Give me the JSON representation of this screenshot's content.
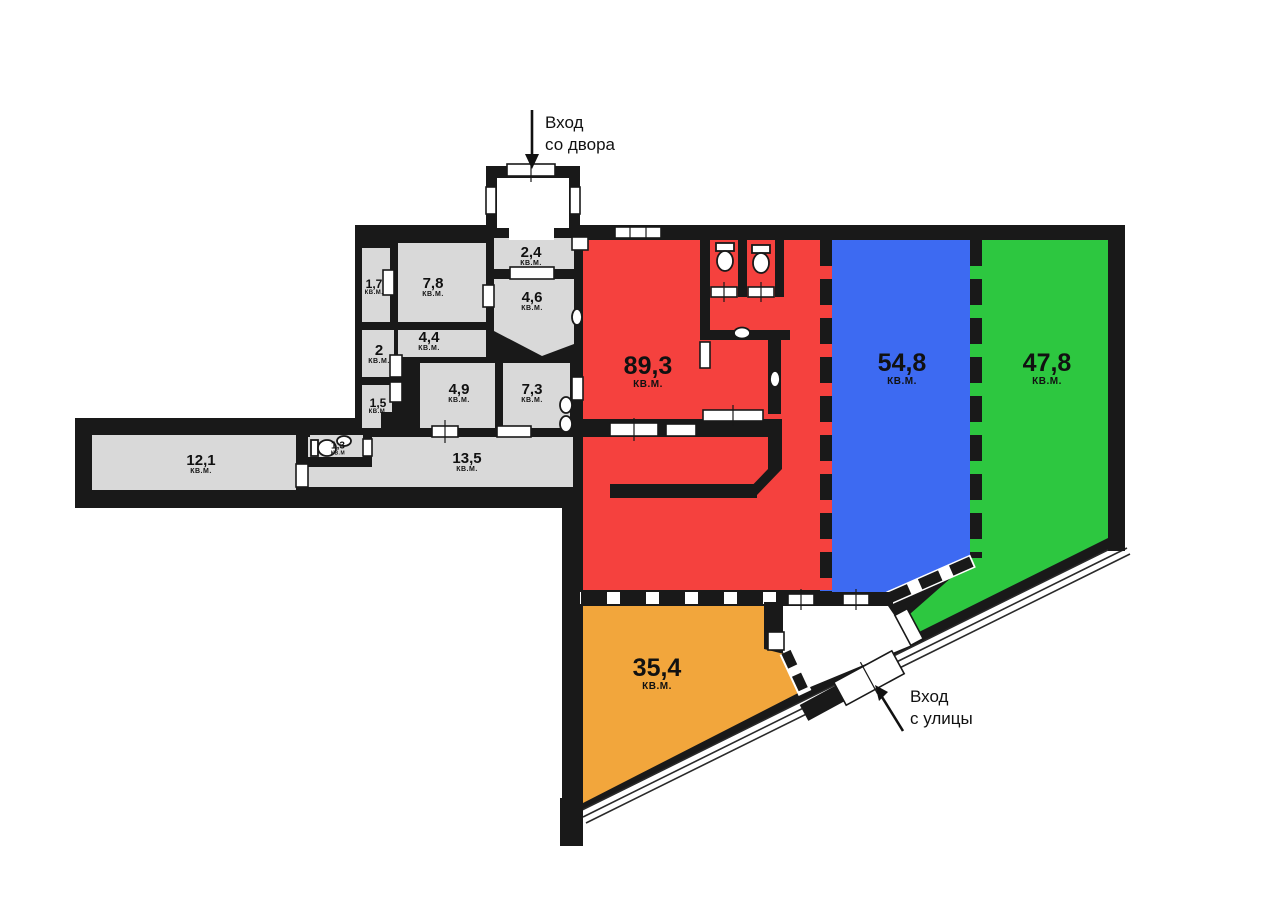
{
  "plan": {
    "unit": "кв.м.",
    "entrances": {
      "courtyard": {
        "line1": "Вход",
        "line2": "со двора"
      },
      "street": {
        "line1": "Вход",
        "line2": "с улицы"
      }
    },
    "labels": {
      "r17": {
        "num": "1,7",
        "unit": "кв.м."
      },
      "r78": {
        "num": "7,8",
        "unit": "кв.м."
      },
      "r24": {
        "num": "2,4",
        "unit": "кв.м."
      },
      "r46": {
        "num": "4,6",
        "unit": "кв.м."
      },
      "r44": {
        "num": "4,4",
        "unit": "кв.м."
      },
      "r2": {
        "num": "2",
        "unit": "кв.м."
      },
      "r15": {
        "num": "1,5",
        "unit": "кв.м."
      },
      "r49": {
        "num": "4,9",
        "unit": "кв.м."
      },
      "r73": {
        "num": "7,3",
        "unit": "кв.м."
      },
      "r121": {
        "num": "12,1",
        "unit": "кв.м."
      },
      "r13": {
        "num": "1,3",
        "unit": "кв.м"
      },
      "r135": {
        "num": "13,5",
        "unit": "кв.м."
      },
      "r893": {
        "num": "89,3",
        "unit": "кв.м."
      },
      "r548": {
        "num": "54,8",
        "unit": "кв.м."
      },
      "r478": {
        "num": "47,8",
        "unit": "кв.м."
      },
      "r354": {
        "num": "35,4",
        "unit": "кв.м."
      }
    },
    "zones": [
      {
        "id": "red-zone",
        "area": "89,3",
        "color": "#F5413E"
      },
      {
        "id": "blue-zone",
        "area": "54,8",
        "color": "#3D6AF2"
      },
      {
        "id": "green-zone",
        "area": "47,8",
        "color": "#2DC740"
      },
      {
        "id": "orange-zone",
        "area": "35,4",
        "color": "#F2A63C"
      },
      {
        "id": "service-rooms",
        "area": "",
        "color": "#D9D9D9"
      }
    ],
    "colors": {
      "wall": "#191919",
      "background": "#FFFFFF"
    }
  }
}
